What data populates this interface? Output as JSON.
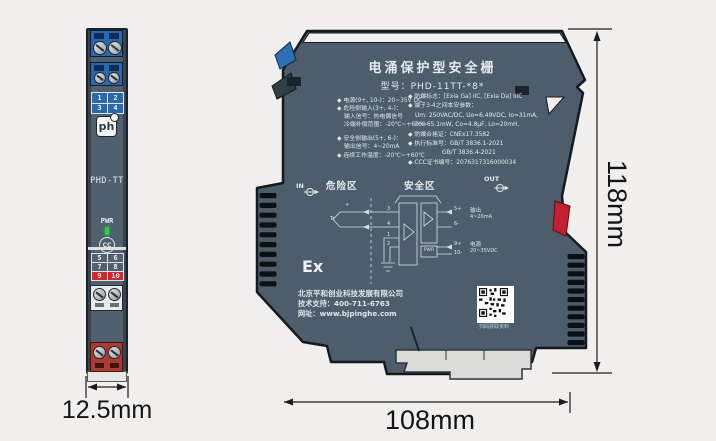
{
  "left_module": {
    "model": "PHD-TT",
    "pwr": "PWR",
    "ccc_mark": "CC",
    "logo": "ph",
    "logo_reg": "R",
    "grid_top": [
      "1",
      "2",
      "3",
      "4"
    ],
    "grid_bottom": [
      "5",
      "6",
      "7",
      "8",
      "9",
      "10"
    ]
  },
  "right_module": {
    "title": "电涌保护型安全栅",
    "model_line": "型号：PHD-11TT-*8*",
    "specs_left": [
      "◆ 电源(9+, 10-)：20~35V DC",
      "◆ 危险侧输入(3+, 4-)：",
      "输入信号：热电偶信号",
      "冷端补偿范围：-20℃~+60℃",
      "◆ 安全侧输出(5+, 6-)：",
      "输出信号：4~20mA",
      "◆ 连续工作温度：-20℃~+60℃"
    ],
    "specs_right": [
      "◆ 防爆标志：[Exia Ga] IIC, [Exia Da] IIIC",
      "◆ 端子3-4之间本安参数：",
      "Um: 250VAC/DC, Uo=6.49VDC, Io=31mA,",
      "Po=65.1mW, Co=4.8μF, Lo=20mH,",
      "◆ 防爆合格证：CNEx17.3582",
      "◆ 执行标准号：GB/T 3836.1-2021",
      "GB/T 3836.4-2021",
      "◆ CCC证书编号：2076317316000034"
    ],
    "zone_hazard": "危险区",
    "zone_safe": "安全区",
    "in_label": "IN",
    "out_label": "OUT",
    "ex_label": "Ex",
    "circuit": {
      "plus": "+",
      "tc": "Tc",
      "t3": "3",
      "t4": "4",
      "t1": "1",
      "t2": "2",
      "t5": "5+",
      "t6": "6-",
      "t9": "9+",
      "t10": "10-",
      "pwr_box": "PWR",
      "output_label": "输出",
      "output_value": "4~20mA",
      "power_label": "电源",
      "power_value": "20~35VDC"
    },
    "company": {
      "name": "北京平和创业科技发展有限公司",
      "support": "技术支持：400-711-6763",
      "website": "网址：www.bjpinghe.com",
      "qr_caption": "扫码获取资料"
    }
  },
  "dimensions": {
    "front_width": "12.5mm",
    "side_width": "108mm",
    "side_height": "118mm"
  },
  "colors": {
    "body": "#4d5d6b",
    "terminal_blue": "#2a68ae",
    "terminal_red": "#a93a34",
    "wedge_red": "#c32032",
    "led_green": "#2bd14a",
    "background": "#f0efed"
  }
}
